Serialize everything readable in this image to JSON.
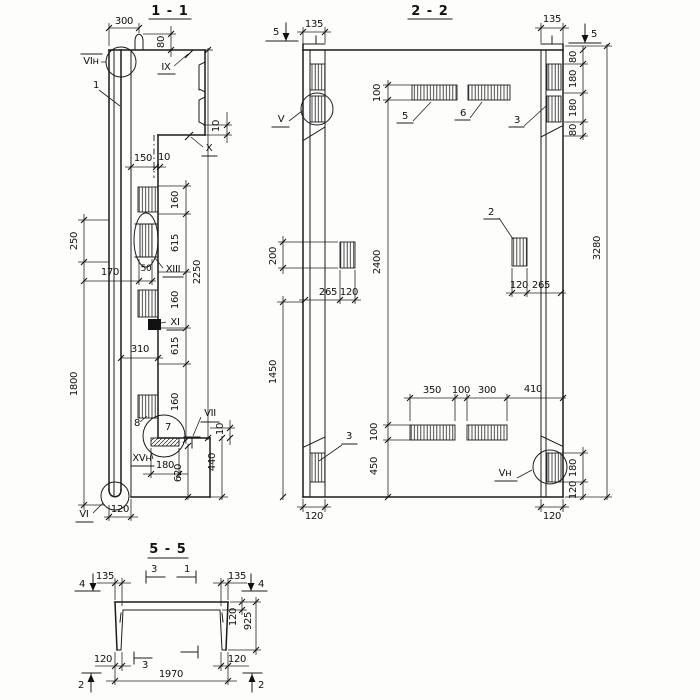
{
  "s11": {
    "title": "1 - 1",
    "marks": {
      "vin": "VIн",
      "ix": "IX",
      "one": "1",
      "x": "X",
      "xiii": "XIII",
      "xi": "XI",
      "vii": "VII",
      "xvn": "XVн",
      "vi": "VI",
      "seven": "7",
      "eight": "8"
    },
    "dims": {
      "d300": "300",
      "d80": "80",
      "d150": "150",
      "d10a": "10",
      "d10b": "10",
      "d10c": "10",
      "d160a": "160",
      "d615a": "615",
      "d160b": "160",
      "d615b": "615",
      "d160c": "160",
      "d2250": "2250",
      "d250": "250",
      "d170": "170",
      "d50": "50",
      "d310": "310",
      "d1800": "1800",
      "d440": "440",
      "d180": "180",
      "d620": "620",
      "d120": "120"
    }
  },
  "s22": {
    "title": "2 - 2",
    "marks": {
      "cut5l": "5",
      "cut5r": "5",
      "v": "V",
      "vn": "Vн",
      "p2": "2",
      "p3r": "3",
      "p3l": "3",
      "p5": "5",
      "p6": "6"
    },
    "dims": {
      "d135l": "135",
      "d135r": "135",
      "d80a": "80",
      "d180a": "180",
      "d180b": "180",
      "d80b": "80",
      "d3280": "3280",
      "d100a": "100",
      "d2400": "2400",
      "d200": "200",
      "d1450": "1450",
      "d265a": "265",
      "d120a": "120",
      "d120b": "120",
      "d265b": "265",
      "d350": "350",
      "d100b": "100",
      "d300": "300",
      "d410": "410",
      "d100c": "100",
      "d450": "450",
      "d180c": "180",
      "d120c": "120",
      "d120d": "120",
      "d120e": "120"
    }
  },
  "s55": {
    "title": "5 - 5",
    "marks": {
      "cut4l": "4",
      "cut4r": "4",
      "cut3t": "3",
      "cut1": "1",
      "cut3b": "3",
      "cut2l": "2",
      "cut2r": "2"
    },
    "dims": {
      "d135l": "135",
      "d135r": "135",
      "d120a": "120",
      "d925": "925",
      "d120bl": "120",
      "d120br": "120",
      "d1970": "1970"
    }
  }
}
